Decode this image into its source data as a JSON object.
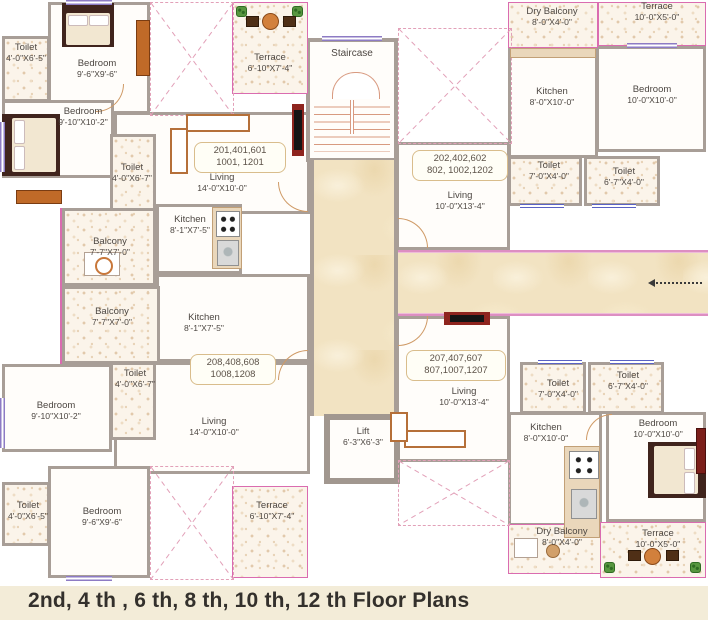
{
  "caption": "2nd, 4 th , 6 th, 8 th, 10 th, 12 th Floor Plans",
  "labels": {
    "staircase": "Staircase",
    "lift_name": "Lift",
    "lift_dims": "6'-3\"X6'-3\""
  },
  "units": {
    "u201": {
      "line1": "201,401,601",
      "line2": "1001, 1201"
    },
    "u202": {
      "line1": "202,402,602",
      "line2": "802, 1002,1202"
    },
    "u207": {
      "line1": "207,407,607",
      "line2": "807,1007,1207"
    },
    "u208": {
      "line1": "208,408,608",
      "line2": "1008,1208"
    }
  },
  "rooms": {
    "toilet_201a": {
      "name": "Toilet",
      "dims": "4'-0\"X6'-5\""
    },
    "bedroom_201a": {
      "name": "Bedroom",
      "dims": "9'-6\"X9'-6\""
    },
    "terrace_201": {
      "name": "Terrace",
      "dims": "6'-10\"X7'-4\""
    },
    "bedroom_201b": {
      "name": "Bedroom",
      "dims": "9'-10\"X10'-2\""
    },
    "toilet_201b": {
      "name": "Toilet",
      "dims": "4'-0\"X6'-7\""
    },
    "living_201": {
      "name": "Living",
      "dims": "14'-0\"X10'-0\""
    },
    "kitchen_201a": {
      "name": "Kitchen",
      "dims": "8'-1\"X7'-5\""
    },
    "balcony_201a": {
      "name": "Balcony",
      "dims": "7'-7\"X7'-0\""
    },
    "balcony_201b": {
      "name": "Balcony",
      "dims": "7'-7\"X7'-0\""
    },
    "kitchen_201b": {
      "name": "Kitchen",
      "dims": "8'-1\"X7'-5\""
    },
    "dry_balcony_202": {
      "name": "Dry Balcony",
      "dims": "8'-0\"X4'-0\""
    },
    "terrace_202": {
      "name": "Terrace",
      "dims": "10'-0\"X5'-0\""
    },
    "kitchen_202": {
      "name": "Kitchen",
      "dims": "8'-0\"X10'-0\""
    },
    "bedroom_202": {
      "name": "Bedroom",
      "dims": "10'-0\"X10'-0\""
    },
    "toilet_202a": {
      "name": "Toilet",
      "dims": "7'-0\"X4'-0\""
    },
    "toilet_202b": {
      "name": "Toilet",
      "dims": "6'-7\"X4'-0\""
    },
    "living_202": {
      "name": "Living",
      "dims": "10'-0\"X13'-4\""
    },
    "living_207": {
      "name": "Living",
      "dims": "10'-0\"X13'-4\""
    },
    "toilet_207a": {
      "name": "Toilet",
      "dims": "7'-0\"X4'-0\""
    },
    "toilet_207b": {
      "name": "Toilet",
      "dims": "6'-7\"X4'-0\""
    },
    "kitchen_207": {
      "name": "Kitchen",
      "dims": "8'-0\"X10'-0\""
    },
    "bedroom_207": {
      "name": "Bedroom",
      "dims": "10'-0\"X10'-0\""
    },
    "dry_balcony_207": {
      "name": "Dry Balcony",
      "dims": "8'-0\"X4'-0\""
    },
    "terrace_207": {
      "name": "Terrace",
      "dims": "10'-0\"X5'-0\""
    },
    "toilet_208a": {
      "name": "Toilet",
      "dims": "4'-0\"X6'-7\""
    },
    "bedroom_208a": {
      "name": "Bedroom",
      "dims": "9'-10\"X10'-2\""
    },
    "living_208": {
      "name": "Living",
      "dims": "14'-0\"X10'-0\""
    },
    "toilet_208b": {
      "name": "Toilet",
      "dims": "4'-0\"X6'-5\""
    },
    "bedroom_208b": {
      "name": "Bedroom",
      "dims": "9'-6\"X9'-6\""
    },
    "terrace_208": {
      "name": "Terrace",
      "dims": "6'-10\"X7'-4\""
    }
  },
  "colors": {
    "wall": "#a89e97",
    "terrace_accent": "#da6cb0",
    "window": "#8d7bc4",
    "marble": "#f2e3c2",
    "stair_tread": "#d89a80",
    "caption_bg": "#f3ecd8"
  }
}
